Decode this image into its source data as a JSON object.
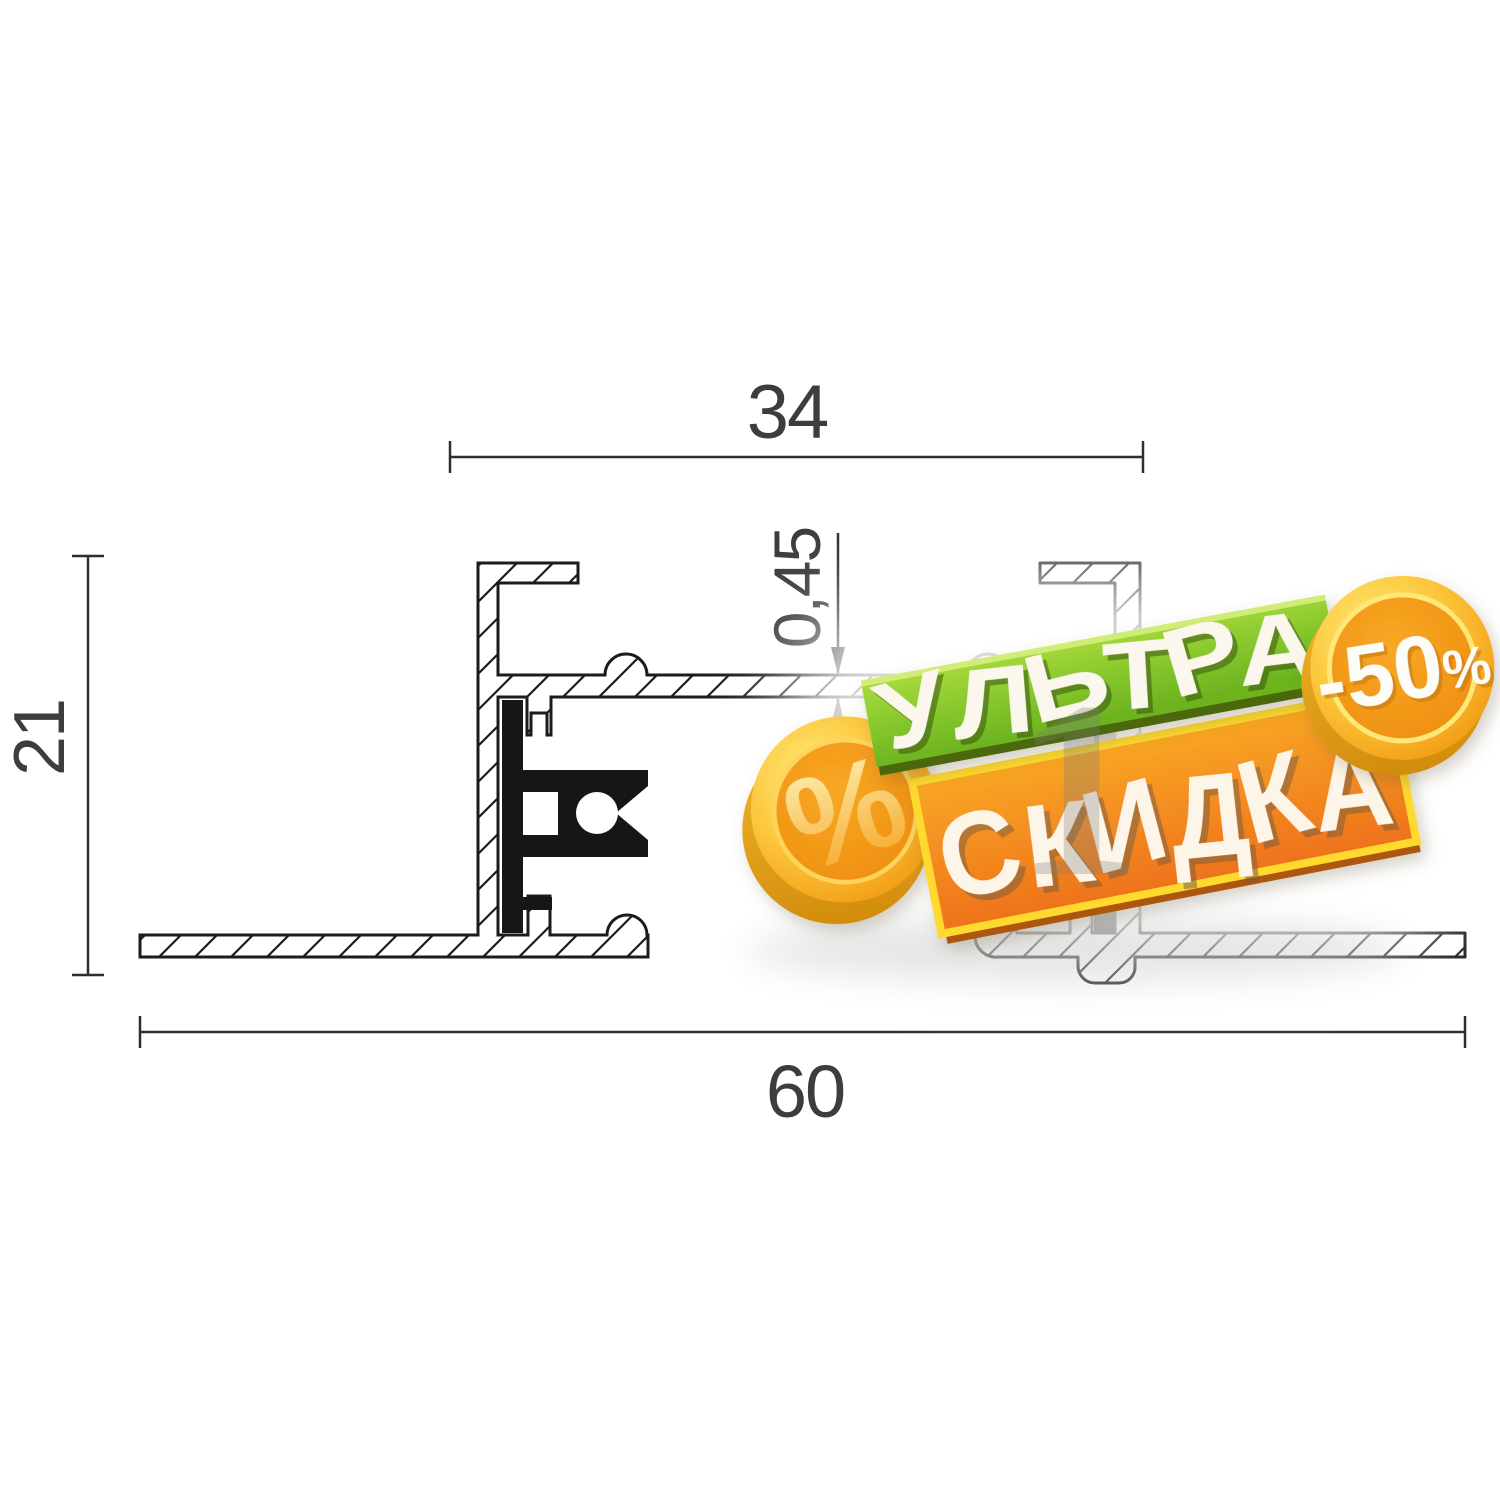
{
  "drawing": {
    "type": "profile-cross-section",
    "dimensions": {
      "top_width": "34",
      "sheet_thickness": "0,45",
      "left_height": "21",
      "bottom_width": "60"
    }
  },
  "badge": {
    "line1": "УЛЬТРА",
    "line2": "СКИДКА",
    "discount_value": "-50",
    "discount_percent": "%",
    "coin_percent": "%",
    "watermark_digit": "1"
  },
  "colors": {
    "line_color": "#1b1b1b",
    "dim_text": "#3d3d3d",
    "banner_green": "#7dc22a",
    "banner_green_dark": "#4c680f",
    "banner_orange": "#f58220",
    "banner_yellow_edge": "#ffd92e",
    "coin_gold": "#f9a81f",
    "coin_light": "#ffeb7a",
    "letter_white": "#fdf5e8"
  }
}
